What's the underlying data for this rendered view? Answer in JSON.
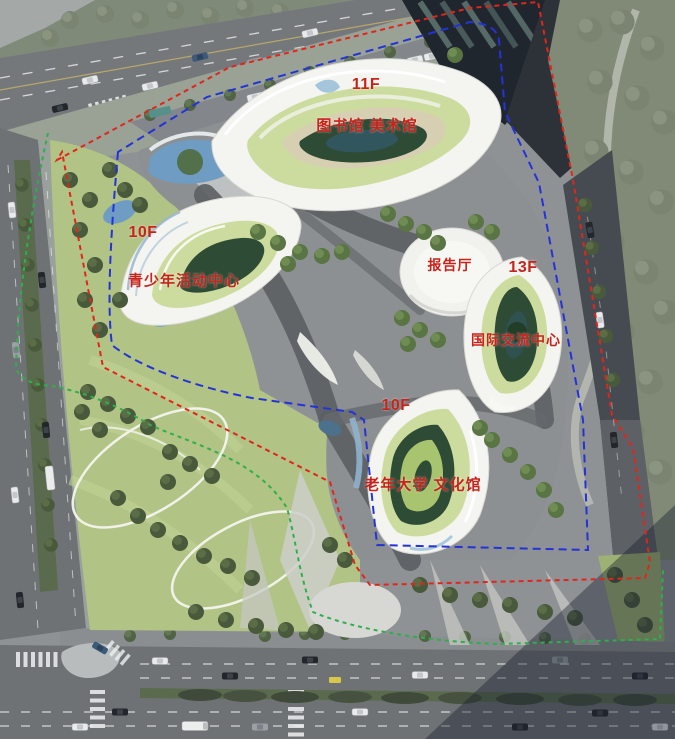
{
  "site_plan": {
    "buildings": {
      "library": {
        "floors": "11F",
        "name": "图书馆 美术馆"
      },
      "youth_center": {
        "floors": "10F",
        "name": "青少年活动中心"
      },
      "lecture_hall": {
        "name": "报告厅"
      },
      "intl_center": {
        "floors": "13F",
        "name": "国际交流中心"
      },
      "senior_center": {
        "floors": "10F",
        "name": "老年大学 文化馆"
      }
    },
    "colors": {
      "label_red": "#c8231b",
      "boundary_red": "#e2251c",
      "setback_blue": "#2433d8",
      "greenway_green": "#2fae4e"
    }
  }
}
